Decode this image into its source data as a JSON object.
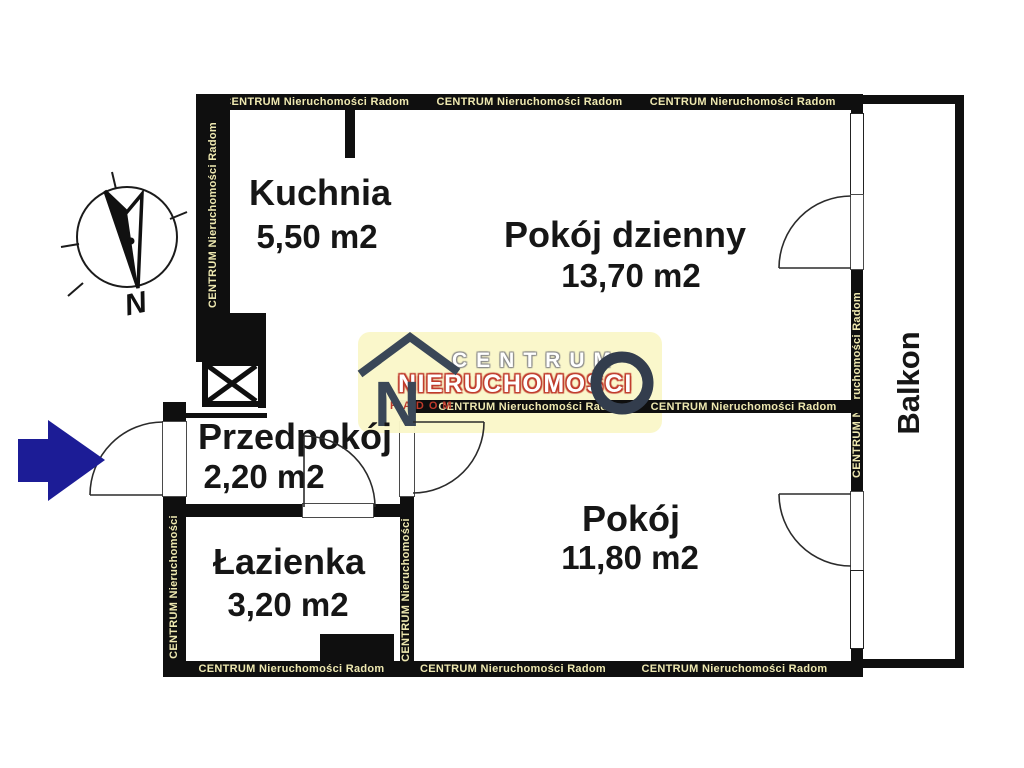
{
  "watermark": {
    "full": "CENTRUM Nieruchomości Radom",
    "short": "CENTRUM Nieruchomości",
    "color": "#eee8b0"
  },
  "rooms": {
    "kuchnia": {
      "name": "Kuchnia",
      "area": "5,50 m2"
    },
    "pokoj_dzienny": {
      "name": "Pokój dzienny",
      "area": "13,70 m2"
    },
    "przedpokoj": {
      "name": "Przedpokój",
      "area": "2,20 m2"
    },
    "lazienka": {
      "name": "Łazienka",
      "area": "3,20 m2"
    },
    "pokoj": {
      "name": "Pokój",
      "area": "11,80 m2"
    },
    "balkon": {
      "name": "Balkon"
    }
  },
  "logo": {
    "letter": "N",
    "brand": "CENTRUM",
    "brand2": "NIERUCHOMOŚCI",
    "city": "RADOM"
  },
  "compass": {
    "north": "N"
  },
  "colors": {
    "wall": "#0f0f0f",
    "watermark_text": "#eee8b0",
    "logo_background": "#f9f6c9",
    "logo_red": "#bf3a2b",
    "logo_dark": "#3a4757",
    "entrance_arrow_blue": "#1c1c96"
  }
}
